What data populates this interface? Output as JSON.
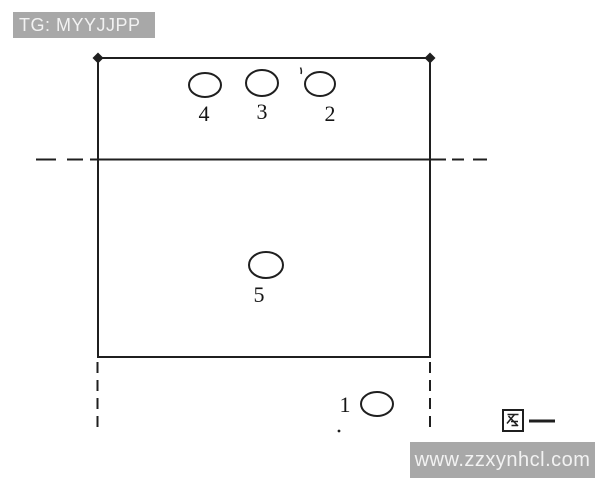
{
  "watermarks": {
    "top_left": "TG: MYYJJPP",
    "bottom_right": "www.zzxynhcl.com"
  },
  "figure": {
    "caption": "图一"
  },
  "court": {
    "positions": [
      {
        "label": "4",
        "cx": 205,
        "cy": 85,
        "rx": 16,
        "ry": 12,
        "lx": 204,
        "ly": 121
      },
      {
        "label": "3",
        "cx": 262,
        "cy": 83,
        "rx": 16,
        "ry": 13,
        "lx": 262,
        "ly": 119
      },
      {
        "label": "2",
        "cx": 320,
        "cy": 84,
        "rx": 15,
        "ry": 12,
        "lx": 330,
        "ly": 121
      },
      {
        "label": "5",
        "cx": 266,
        "cy": 265,
        "rx": 17,
        "ry": 13,
        "lx": 259,
        "ly": 302
      },
      {
        "label": "1",
        "cx": 377,
        "cy": 404,
        "rx": 16,
        "ry": 12,
        "lx": 345,
        "ly": 412
      }
    ]
  },
  "colors": {
    "background": "#ffffff",
    "line": "#1f1f1f",
    "bar_background": "#a8a8a8",
    "bar_text": "#f2f2f2"
  }
}
